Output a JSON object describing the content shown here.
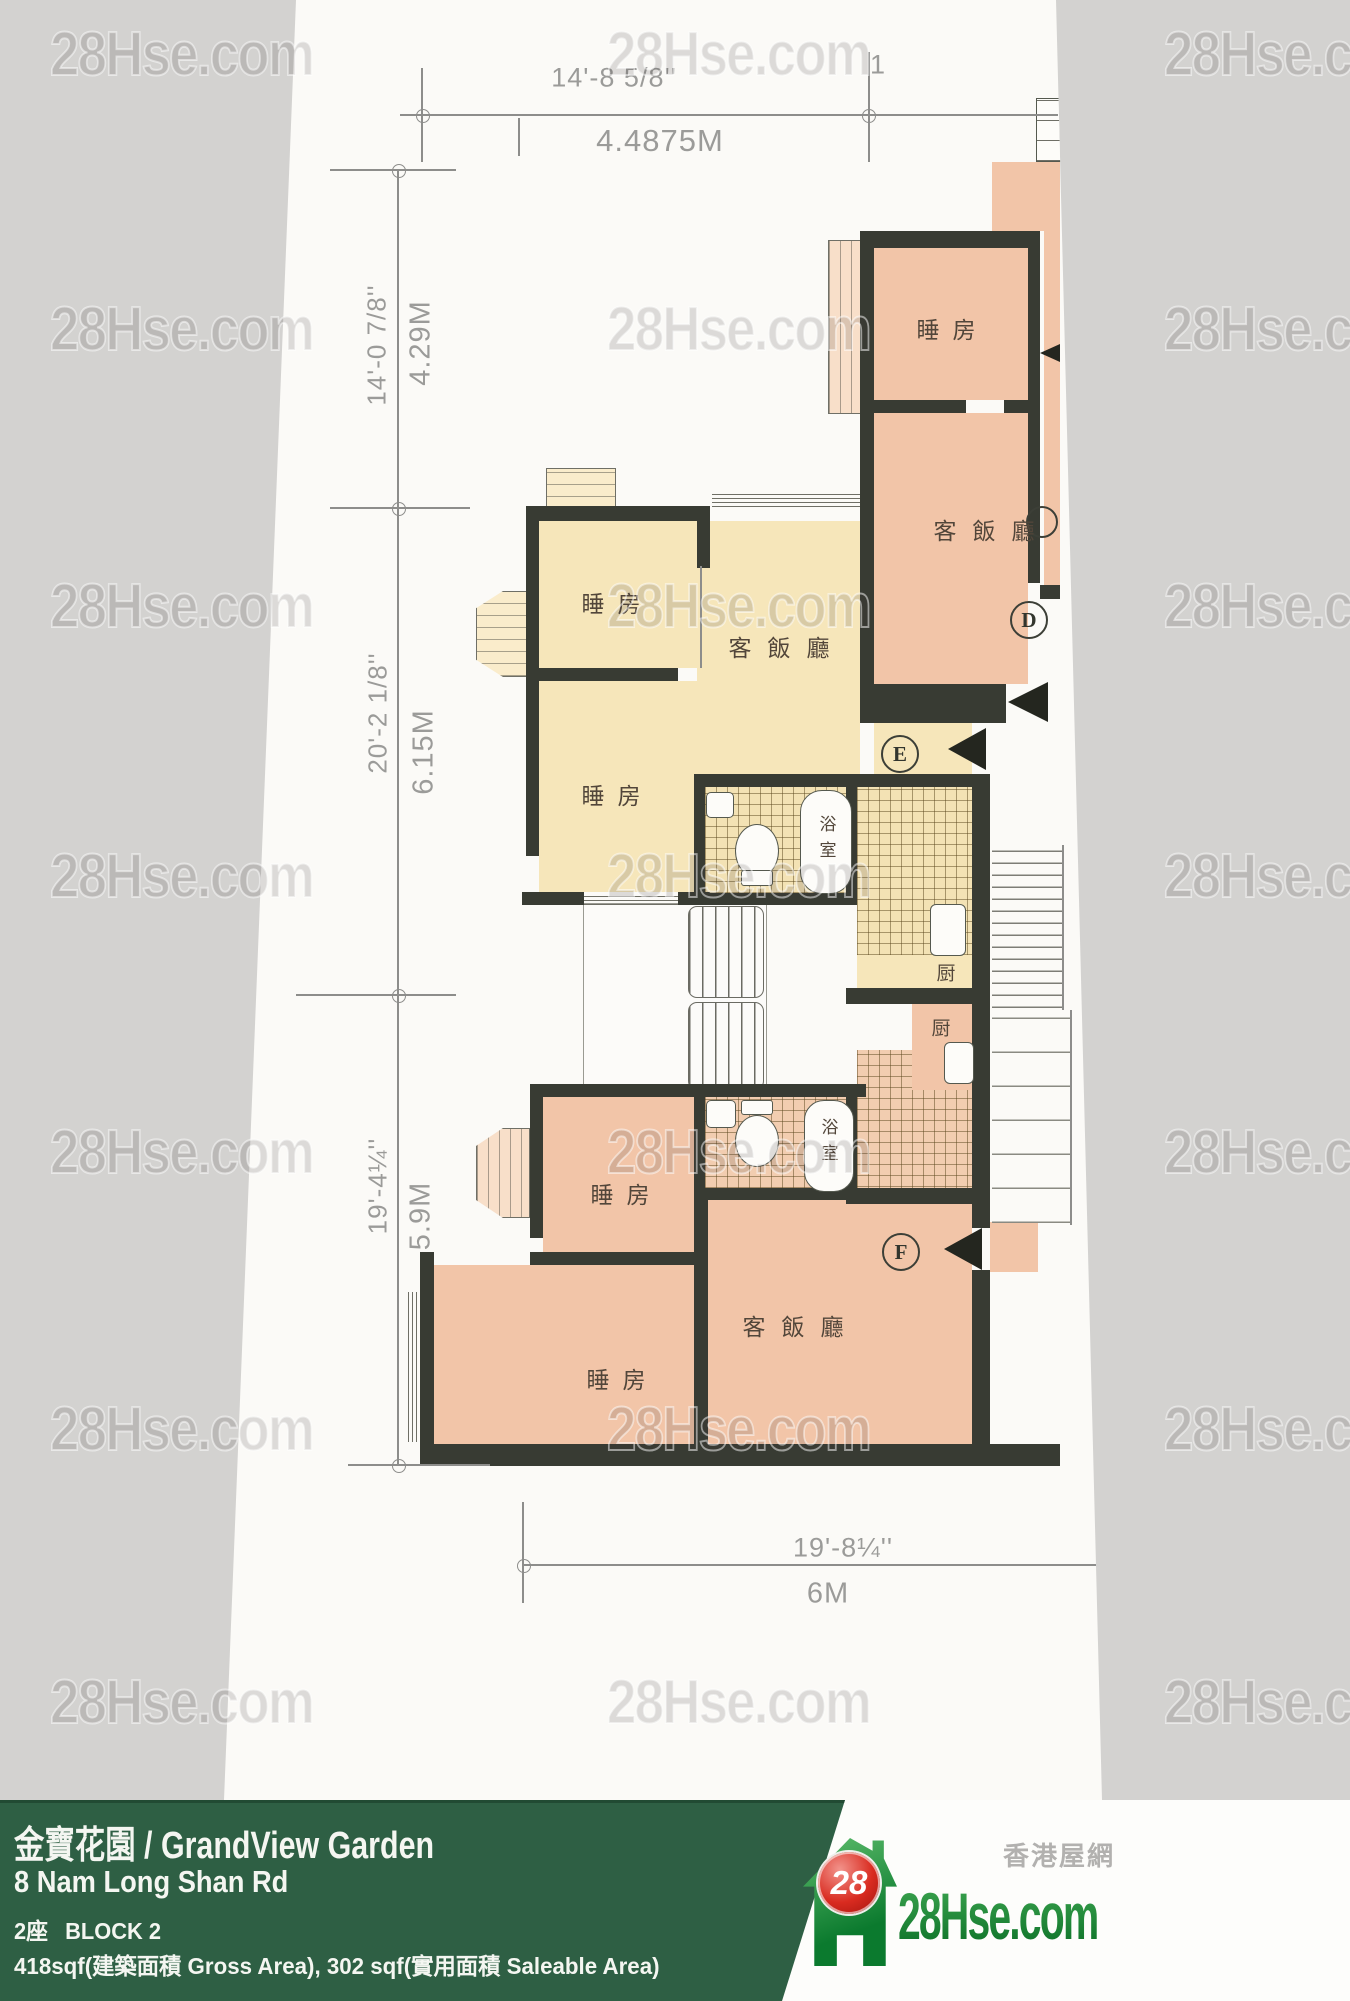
{
  "watermark": {
    "text": "28Hse.com"
  },
  "plan": {
    "labels": {
      "bedroom": "睡房",
      "living_dining": "客飯廳",
      "bathroom": "浴室",
      "kitchen": "厨"
    },
    "units": {
      "d": "D",
      "e": "E",
      "f": "F"
    },
    "dimensions": {
      "top_ft": "14'-8 5/8''",
      "top_m": "4.4875M",
      "top_right_partial": "1",
      "left1_ft": "14'-0 7/8''",
      "left1_m": "4.29M",
      "left2_ft": "20'-2 1/8''",
      "left2_m": "6.15M",
      "left3_ft": "19'-4¼''",
      "left3_m": "5.9M",
      "bottom_ft": "19'-8¼''",
      "bottom_m": "6M"
    }
  },
  "footer": {
    "title": "金寶花園 / GrandView Garden",
    "address": "8 Nam Long Shan Rd",
    "block_zh": "2座",
    "block_en": "BLOCK 2",
    "area": "418sqf(建築面積 Gross Area), 302 sqf(實用面積 Saleable Area)",
    "logo": {
      "badge": "28",
      "site": "28Hse.com",
      "tagline": "香港屋網"
    }
  },
  "colors": {
    "unit_pink": "#f2c5a8",
    "unit_yellow": "#f6e6ba",
    "bar_green": "#2e5f44",
    "logo_green": "#15813a",
    "logo_red": "#d92b20"
  }
}
